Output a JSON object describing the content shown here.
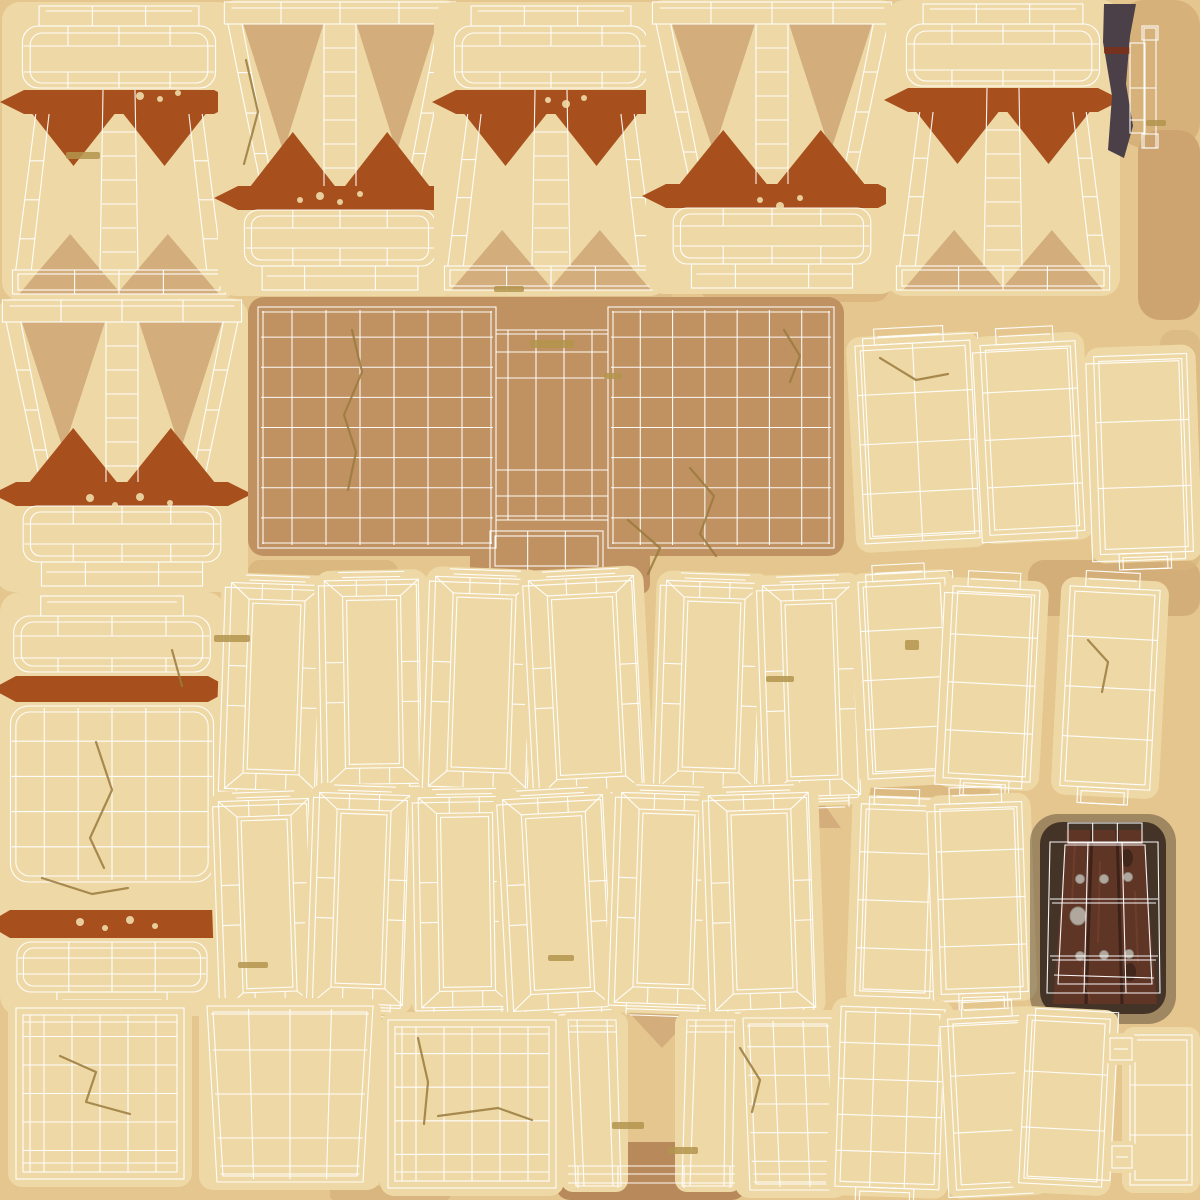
{
  "canvas": {
    "w": 1200,
    "h": 1200
  },
  "colors": {
    "bg": "#e4c68e",
    "island": "#eed9a6",
    "wire": "#ffffff",
    "rust": "#a8501d",
    "shadowTri": "#d3ae7c",
    "panel": "#c09261",
    "crack": "#9a7a3e",
    "dash": "#b3944e",
    "speckle": "#eedcab",
    "doorShadow": "#37291f",
    "cornerShadow": "#4b4047",
    "redLine": "#7d3018",
    "wood": "#5f3526",
    "woodDark": "#3c2218",
    "woodLight": "#7b452e",
    "knot": "#40261b",
    "stud": "#b1a89d",
    "studEdge": "#8f877d"
  },
  "patches": [
    {
      "x": 1118,
      "y": 0,
      "w": 82,
      "h": 148,
      "rx": 26,
      "c": "#d6b27a",
      "o": 1
    },
    {
      "x": 1138,
      "y": 130,
      "w": 62,
      "h": 190,
      "rx": 22,
      "c": "#cda470",
      "o": 1
    },
    {
      "x": 556,
      "y": 130,
      "w": 120,
      "h": 180,
      "rx": 30,
      "c": "#dcbb85",
      "o": 0.75
    },
    {
      "x": 736,
      "y": 60,
      "w": 130,
      "h": 150,
      "rx": 30,
      "c": "#dcbb85",
      "o": 0.6
    },
    {
      "x": 700,
      "y": 248,
      "w": 190,
      "h": 54,
      "rx": 16,
      "c": "#d8b37c",
      "o": 0.8
    },
    {
      "x": 60,
      "y": 285,
      "w": 140,
      "h": 30,
      "rx": 10,
      "c": "#d8b37c",
      "o": 0.6
    },
    {
      "x": 248,
      "y": 560,
      "w": 150,
      "h": 36,
      "rx": 12,
      "c": "#d6b27b",
      "o": 0.7
    },
    {
      "x": 556,
      "y": 1142,
      "w": 190,
      "h": 58,
      "rx": 14,
      "c": "#b8895b",
      "o": 1
    },
    {
      "x": 860,
      "y": 772,
      "w": 130,
      "h": 36,
      "rx": 12,
      "c": "#d8b47d",
      "o": 0.65
    },
    {
      "x": 1028,
      "y": 560,
      "w": 172,
      "h": 56,
      "rx": 16,
      "c": "#cda470",
      "o": 0.7
    },
    {
      "x": 1160,
      "y": 330,
      "w": 40,
      "h": 240,
      "rx": 14,
      "c": "#d8b47d",
      "o": 0.6
    },
    {
      "x": 980,
      "y": 1008,
      "w": 46,
      "h": 180,
      "rx": 14,
      "c": "#d2ab74",
      "o": 0.5
    },
    {
      "x": 330,
      "y": 1186,
      "w": 120,
      "h": 14,
      "rx": 4,
      "c": "#d2ab74",
      "o": 0.6
    }
  ],
  "fadedTriangles": [
    {
      "cx": 376,
      "y": 603,
      "hw": 39,
      "ht": 36,
      "dir": 1
    },
    {
      "cx": 585,
      "y": 605,
      "hw": 40,
      "ht": 42,
      "dir": 1
    },
    {
      "cx": 712,
      "y": 607,
      "hw": 37,
      "ht": 30,
      "dir": 1
    },
    {
      "cx": 290,
      "y": 828,
      "hw": 42,
      "ht": 62,
      "dir": -1
    },
    {
      "cx": 493,
      "y": 828,
      "hw": 49,
      "ht": 56,
      "dir": -1
    },
    {
      "cx": 804,
      "y": 828,
      "hw": 37,
      "ht": 52,
      "dir": -1
    },
    {
      "cx": 364,
      "y": 829,
      "hw": 40,
      "ht": 34,
      "dir": 1
    },
    {
      "cx": 465,
      "y": 829,
      "hw": 41,
      "ht": 32,
      "dir": 1
    },
    {
      "cx": 677,
      "y": 843,
      "hw": 37,
      "ht": 29,
      "dir": 1
    },
    {
      "cx": 261,
      "y": 1043,
      "hw": 41,
      "ht": 57,
      "dir": -1
    },
    {
      "cx": 557,
      "y": 1043,
      "hw": 51,
      "ht": 61,
      "dir": -1
    },
    {
      "cx": 779,
      "y": 1043,
      "hw": 41,
      "ht": 49,
      "dir": -1
    },
    {
      "cx": 662,
      "y": 1005,
      "hw": 40,
      "ht": 43,
      "dir": 1
    }
  ],
  "islands": [
    {
      "id": "pillar-capital-1",
      "type": "pillarCapital",
      "x": 8,
      "y": 6,
      "w": 222,
      "h": 288
    },
    {
      "id": "pillar-base-1",
      "type": "pillarBase",
      "x": 222,
      "y": 2,
      "w": 236,
      "h": 288
    },
    {
      "id": "pillar-capital-2",
      "type": "pillarCapital",
      "x": 440,
      "y": 6,
      "w": 222,
      "h": 284
    },
    {
      "id": "pillar-base-2",
      "type": "pillarBase",
      "x": 650,
      "y": 2,
      "w": 244,
      "h": 286
    },
    {
      "id": "pillar-capital-3",
      "type": "pillarCapital",
      "x": 892,
      "y": 4,
      "w": 222,
      "h": 286
    },
    {
      "id": "door-edge-corner",
      "type": "cornerEdge",
      "blob": [
        [
          1104,
          4
        ],
        [
          1136,
          4
        ],
        [
          1130,
          36
        ],
        [
          1126,
          84
        ],
        [
          1133,
          126
        ],
        [
          1124,
          158
        ],
        [
          1108,
          150
        ],
        [
          1112,
          96
        ],
        [
          1103,
          42
        ]
      ],
      "red": [
        1104,
        47,
        26,
        7
      ],
      "rects": [
        [
          1130,
          43,
          15,
          90
        ],
        [
          1144,
          28,
          12,
          120
        ]
      ],
      "caps": [
        [
          1142,
          26,
          16,
          14
        ],
        [
          1142,
          134,
          16,
          14
        ]
      ],
      "mid": [
        [
          1130,
          88,
          1156,
          88
        ],
        [
          1130,
          120,
          1144,
          120
        ]
      ]
    },
    {
      "id": "pillar-base-3",
      "type": "pillarBase",
      "x": 0,
      "y": 300,
      "w": 244,
      "h": 286
    },
    {
      "id": "stone-panel",
      "type": "bigPanel",
      "x": 258,
      "y": 307,
      "w": 576,
      "h": 241,
      "lp": [
        258,
        307,
        238,
        241
      ],
      "rp": [
        608,
        307,
        226,
        241
      ],
      "midTop": 330,
      "midBot": 520,
      "midV": [
        508,
        536,
        564,
        592
      ],
      "midH": [
        330,
        352,
        378,
        470,
        496,
        520
      ],
      "rect": [
        490,
        531,
        113,
        40
      ],
      "blob2": [
        470,
        548,
        180,
        46
      ]
    },
    {
      "id": "strip-1",
      "type": "strip",
      "x": 860,
      "y": 343,
      "w": 115,
      "h": 198,
      "slant": -3,
      "rows": 3,
      "cols": 2,
      "topTab": true,
      "bottomTab": false,
      "shells": "right"
    },
    {
      "id": "strip-2",
      "type": "strip",
      "x": 985,
      "y": 343,
      "w": 95,
      "h": 190,
      "slant": -3,
      "rows": 3,
      "cols": 1,
      "topTab": true,
      "bottomTab": false,
      "shells": "left"
    },
    {
      "id": "strip-3",
      "type": "strip",
      "x": 1097,
      "y": 355,
      "w": 93,
      "h": 198,
      "slant": -2,
      "rows": 2,
      "cols": 1,
      "topTab": false,
      "bottomTab": true,
      "shells": "left"
    },
    {
      "id": "barrel-pillar",
      "type": "barrel",
      "x": 4,
      "y": 596,
      "w": 216,
      "h": 412
    },
    {
      "id": "frame-1",
      "type": "frame",
      "x": 228,
      "y": 584,
      "w": 92,
      "h": 206,
      "rot": 2
    },
    {
      "id": "frame-2",
      "type": "frame",
      "x": 326,
      "y": 580,
      "w": 94,
      "h": 204,
      "rot": -1
    },
    {
      "id": "frame-3",
      "type": "frame",
      "x": 432,
      "y": 578,
      "w": 99,
      "h": 210,
      "rot": 2
    },
    {
      "id": "frame-4",
      "type": "frame",
      "x": 534,
      "y": 578,
      "w": 105,
      "h": 216,
      "rot": -3
    },
    {
      "id": "frame-5",
      "type": "frame",
      "x": 663,
      "y": 582,
      "w": 97,
      "h": 206,
      "rot": 2
    },
    {
      "id": "frame-6",
      "type": "frame",
      "x": 766,
      "y": 584,
      "w": 91,
      "h": 212,
      "rot": -2
    },
    {
      "id": "strip-4",
      "type": "strip",
      "x": 863,
      "y": 580,
      "w": 87,
      "h": 197,
      "slant": -3,
      "rows": 3,
      "cols": 1,
      "topTab": true,
      "bottomTab": false,
      "shells": "right"
    },
    {
      "id": "strip-5",
      "type": "strip",
      "x": 948,
      "y": 588,
      "w": 87,
      "h": 192,
      "slant": 3,
      "rows": 3,
      "cols": 1,
      "topTab": true,
      "bottomTab": true,
      "shells": "left"
    },
    {
      "id": "strip-6",
      "type": "strip",
      "x": 1065,
      "y": 588,
      "w": 90,
      "h": 200,
      "slant": 3,
      "rows": 3,
      "cols": 1,
      "topTab": true,
      "bottomTab": true,
      "shells": "none"
    },
    {
      "id": "frame-7",
      "type": "frame",
      "x": 222,
      "y": 800,
      "w": 90,
      "h": 208,
      "rot": -2
    },
    {
      "id": "frame-8",
      "type": "frame",
      "x": 316,
      "y": 794,
      "w": 90,
      "h": 210,
      "rot": 2
    },
    {
      "id": "frame-9",
      "type": "frame",
      "x": 420,
      "y": 797,
      "w": 92,
      "h": 210,
      "rot": -1
    },
    {
      "id": "frame-10",
      "type": "frame",
      "x": 508,
      "y": 797,
      "w": 100,
      "h": 212,
      "rot": -3
    },
    {
      "id": "frame-11",
      "type": "frame",
      "x": 618,
      "y": 794,
      "w": 96,
      "h": 210,
      "rot": 2
    },
    {
      "id": "frame-12",
      "type": "frame",
      "x": 712,
      "y": 794,
      "w": 100,
      "h": 215,
      "rot": -2
    },
    {
      "id": "strip-7",
      "type": "strip",
      "x": 858,
      "y": 805,
      "w": 75,
      "h": 192,
      "slant": 2,
      "rows": 3,
      "cols": 1,
      "topTab": true,
      "bottomTab": false,
      "shells": "right"
    },
    {
      "id": "strip-8",
      "type": "strip",
      "x": 938,
      "y": 803,
      "w": 87,
      "h": 190,
      "slant": -2,
      "rows": 3,
      "cols": 1,
      "topTab": true,
      "bottomTab": true,
      "shells": "left"
    },
    {
      "id": "wood-door",
      "type": "door",
      "shadow": [
        1040,
        822,
        126,
        192
      ],
      "wood": [
        [
          1066,
          830
        ],
        [
          1143,
          830
        ],
        [
          1157,
          1004
        ],
        [
          1053,
          1004
        ]
      ],
      "gaps": [
        [
          1092,
          830,
          1086,
          1004
        ],
        [
          1117,
          830,
          1122,
          1004
        ]
      ],
      "streaks": [
        [
          1075,
          842,
          1072,
          902
        ],
        [
          1100,
          862,
          1098,
          942
        ],
        [
          1135,
          892,
          1138,
          962
        ],
        [
          1082,
          968,
          1090,
          1000
        ]
      ],
      "studs": [
        [
          1080,
          879
        ],
        [
          1104,
          879
        ],
        [
          1128,
          877
        ],
        [
          1080,
          956
        ],
        [
          1104,
          955
        ],
        [
          1129,
          954
        ]
      ],
      "bigStud": [
        1078,
        916
      ],
      "knots": [
        [
          1127,
          858
        ],
        [
          1130,
          972
        ]
      ],
      "wireOuter": [
        [
          1050,
          842
        ],
        [
          1158,
          842
        ],
        [
          1160,
          993
        ],
        [
          1047,
          993
        ]
      ],
      "wireInner": [
        [
          1065,
          845
        ],
        [
          1145,
          845
        ],
        [
          1152,
          984
        ],
        [
          1058,
          984
        ]
      ],
      "cap": [
        1068,
        823,
        74,
        20
      ],
      "hLines": [
        899,
        956
      ],
      "vLines": [
        [
          1088,
          842,
          1084,
          993
        ],
        [
          1122,
          842,
          1126,
          993
        ]
      ]
    },
    {
      "id": "grid-square-1",
      "type": "gridSquare",
      "x": 16,
      "y": 1008,
      "w": 168,
      "h": 171,
      "cols": 6,
      "rows": 6
    },
    {
      "id": "trapezoid-panel-1",
      "type": "trapGrid",
      "x": 207,
      "y": 1006,
      "w": 166,
      "h": 176,
      "insBot": 10,
      "shift": 0,
      "cols": 4,
      "rows": 3
    },
    {
      "id": "grid-square-2",
      "type": "gridSquare",
      "x": 388,
      "y": 1020,
      "w": 168,
      "h": 168,
      "cols": 6,
      "rows": 5
    },
    {
      "id": "door-legs",
      "type": "legs",
      "leg1": [
        [
          568,
          1020
        ],
        [
          616,
          1020
        ],
        [
          621,
          1186
        ],
        [
          576,
          1186
        ]
      ],
      "leg2": [
        [
          687,
          1020
        ],
        [
          735,
          1020
        ],
        [
          732,
          1186
        ],
        [
          682,
          1186
        ]
      ],
      "bars": [
        1166,
        1174,
        1183
      ],
      "barSpan": [
        568,
        736
      ],
      "capY": 1032
    },
    {
      "id": "trapezoid-panel-2",
      "type": "trapGrid",
      "x": 743,
      "y": 1018,
      "w": 90,
      "h": 172,
      "insBot": 0,
      "shift": 7,
      "cols": 3,
      "rows": 5
    },
    {
      "id": "strip-9",
      "type": "strip",
      "x": 838,
      "y": 1008,
      "w": 104,
      "h": 180,
      "slant": 2,
      "rows": 4,
      "cols": 3,
      "topTab": false,
      "bottomTab": true,
      "shells": "none"
    },
    {
      "id": "strip-10",
      "type": "strip",
      "x": 952,
      "y": 1017,
      "w": 84,
      "h": 171,
      "slant": -3,
      "rows": 2,
      "cols": 1,
      "topTab": true,
      "bottomTab": false,
      "shells": "left"
    },
    {
      "id": "strip-11",
      "type": "strip",
      "x": 1023,
      "y": 1017,
      "w": 83,
      "h": 168,
      "slant": 3,
      "rows": 2,
      "cols": 1,
      "topTab": false,
      "bottomTab": false,
      "shells": "right"
    },
    {
      "id": "tab-panel",
      "type": "tabStrip",
      "x": 1130,
      "y": 1035,
      "w": 62,
      "h": 150,
      "rows": 2,
      "tabs": [
        [
          1110,
          1038,
          22,
          22
        ],
        [
          1112,
          1146,
          20,
          22
        ]
      ]
    }
  ],
  "cracks": [
    {
      "pts": [
        [
          352,
          330
        ],
        [
          362,
          372
        ],
        [
          344,
          415
        ],
        [
          356,
          452
        ],
        [
          348,
          490
        ]
      ]
    },
    {
      "pts": [
        [
          690,
          468
        ],
        [
          714,
          496
        ],
        [
          700,
          534
        ],
        [
          716,
          556
        ]
      ]
    },
    {
      "pts": [
        [
          784,
          330
        ],
        [
          800,
          356
        ],
        [
          790,
          382
        ]
      ]
    },
    {
      "pts": [
        [
          628,
          520
        ],
        [
          660,
          548
        ],
        [
          648,
          574
        ]
      ]
    },
    {
      "pts": [
        [
          96,
          742
        ],
        [
          112,
          790
        ],
        [
          90,
          838
        ],
        [
          104,
          868
        ]
      ]
    },
    {
      "pts": [
        [
          42,
          878
        ],
        [
          92,
          894
        ],
        [
          128,
          888
        ]
      ]
    },
    {
      "pts": [
        [
          172,
          650
        ],
        [
          182,
          686
        ]
      ]
    },
    {
      "pts": [
        [
          60,
          1056
        ],
        [
          96,
          1072
        ],
        [
          86,
          1102
        ],
        [
          130,
          1114
        ]
      ]
    },
    {
      "pts": [
        [
          418,
          1038
        ],
        [
          428,
          1082
        ],
        [
          424,
          1124
        ]
      ]
    },
    {
      "pts": [
        [
          438,
          1116
        ],
        [
          498,
          1108
        ],
        [
          532,
          1120
        ]
      ]
    },
    {
      "pts": [
        [
          880,
          358
        ],
        [
          916,
          380
        ],
        [
          948,
          374
        ]
      ]
    },
    {
      "pts": [
        [
          1088,
          640
        ],
        [
          1108,
          662
        ],
        [
          1102,
          692
        ]
      ]
    },
    {
      "pts": [
        [
          246,
          60
        ],
        [
          258,
          112
        ],
        [
          244,
          164
        ]
      ]
    },
    {
      "pts": [
        [
          740,
          1048
        ],
        [
          760,
          1080
        ],
        [
          752,
          1112
        ]
      ]
    }
  ],
  "dashes": [
    [
      66,
      152,
      34,
      7
    ],
    [
      530,
      340,
      44,
      8
    ],
    [
      214,
      635,
      36,
      7
    ],
    [
      604,
      373,
      18,
      6
    ],
    [
      766,
      676,
      28,
      6
    ],
    [
      238,
      962,
      30,
      6
    ],
    [
      548,
      955,
      26,
      6
    ],
    [
      612,
      1122,
      32,
      7
    ],
    [
      905,
      640,
      14,
      10
    ],
    [
      1146,
      120,
      20,
      6
    ],
    [
      494,
      286,
      30,
      6
    ],
    [
      668,
      1147,
      30,
      7
    ]
  ],
  "speckles": [
    [
      140,
      96,
      4
    ],
    [
      160,
      99,
      3
    ],
    [
      178,
      93,
      3
    ],
    [
      548,
      100,
      3
    ],
    [
      566,
      104,
      4
    ],
    [
      584,
      98,
      3
    ],
    [
      320,
      196,
      4
    ],
    [
      340,
      202,
      3
    ],
    [
      360,
      194,
      3
    ],
    [
      300,
      200,
      3
    ],
    [
      90,
      498,
      4
    ],
    [
      115,
      505,
      3
    ],
    [
      140,
      497,
      4
    ],
    [
      170,
      503,
      3
    ],
    [
      80,
      922,
      4
    ],
    [
      105,
      928,
      3
    ],
    [
      130,
      920,
      4
    ],
    [
      155,
      926,
      3
    ],
    [
      760,
      200,
      3
    ],
    [
      780,
      206,
      4
    ],
    [
      800,
      198,
      3
    ]
  ]
}
